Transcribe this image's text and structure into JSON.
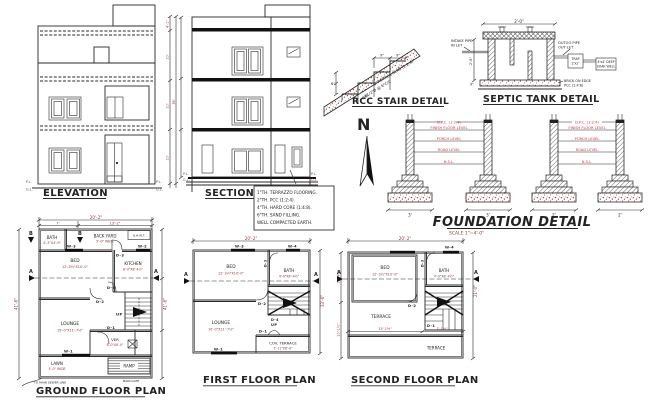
{
  "elevation": {
    "title": "ELEVATION",
    "pl": "P.L.",
    "gl": "G.L.",
    "dim_total": "38'",
    "dim_seg_top": "4'-1\"",
    "dim_seg_1": "10'",
    "dim_seg_2": "10'",
    "dim_seg_3": "10'"
  },
  "section": {
    "title": "SECTION A-A",
    "pl": "P.L.",
    "gl": "G.L."
  },
  "stair": {
    "title": "RCC STAIR DETAIL",
    "slab_note": "6\"THK RCC SLAB (1:2:4)",
    "bar_note": "#1/2\"Ø @ 6\"C/C",
    "bb": "B/B",
    "tread_dim_a": "9\"",
    "tread_dim_b": "9\"",
    "riser_dim": "6\""
  },
  "north": {
    "label": "N"
  },
  "septic": {
    "title": "SEPTIC TANK DETAIL",
    "top_dim": "2'-0\"",
    "inlet_1": "INTAKE PIPE",
    "inlet_2": "IN LET",
    "outlet_1": "OUTGO PIPE",
    "outlet_2": "OUT LET",
    "trap_1": "TRAP",
    "trap_2": "2'x2'",
    "soak_1": "4'x4' DEEP",
    "soak_2": "SOAK WELL",
    "brick": "BRICK ON EDGE",
    "pcc": "PCC (1:4:8)",
    "depth_dim": "2'-6\"",
    "base_dim": "9\""
  },
  "foundation": {
    "title": "FOUNDATION DETAIL",
    "scale": "SCALE 1\"=4'-0\"",
    "labels": [
      "D.P.C. (1:2:4)",
      "FINISH FLOOR LEVEL",
      "PORCH LEVEL",
      "ROAD LEVEL",
      "N.S.L."
    ],
    "dims": [
      "3'",
      "3'",
      "2'",
      "2'"
    ]
  },
  "notes": {
    "lines": [
      "1\"TH. TERRAZZO FLOORING.",
      "2\"TH. PCC (1:2:4).",
      "4\"TH. HARD CORE (1:4:8).",
      "6\"TH. SAND FILLING.",
      "WELL COMPACTED EARTH."
    ]
  },
  "ground": {
    "title": "GROUND FLOOR PLAN",
    "dim_top": "20'-2\"",
    "dim_seg_l": "7'",
    "dim_seg_r": "13'-2\"",
    "dim_side_l": "41'-6\"",
    "dim_side_r": "41'-6\"",
    "bath": "BATH",
    "bath_dim": "4'-3\"X4'-9\"",
    "backyard_1": "BACK YARD",
    "backyard_2": "5'-0\" WIDE",
    "ohwt": "O.H.W.T.",
    "bed": "BED",
    "bed_dim": "12'-3½\"X10'-0\"",
    "kitchen": "KITCHEN",
    "kitchen_dim": "8'-0\"X8'-4½\"",
    "lounge": "LOUNGE",
    "lounge_dim": "10'-0\"X11'-7½\"",
    "ver": "VER",
    "ver_dim": "8'-0\"X6'-0\"",
    "lawn": "LAWN",
    "lawn_dim": "5'-0\" WIDE",
    "ramp": "RAMP",
    "main_gate": "MAIN GATE",
    "sewer": "TO MAIN SEWER LINE",
    "up": "UP",
    "a": "A",
    "b": "B",
    "d1": "D-1",
    "d2": "D-2",
    "d3": "D-3",
    "w1": "W-1",
    "w2": "W-2",
    "w3": "W-3"
  },
  "first": {
    "title": "FIRST FLOOR PLAN",
    "dim_top": "20'-2\"",
    "dim_side": "33'-6\"",
    "bed": "BED",
    "bed_dim": "12'-3½\"X10'-0\"",
    "bath": "BATH",
    "bath_dim": "4'-0\"X8'-4½\"",
    "lounge": "LOUNGE",
    "lounge_dim": "10'-0\"X11'-7½\"",
    "terrace_1": "COV. TERRACE",
    "terrace_2": "7'-11\"X6'-9\"",
    "up": "UP",
    "a": "A",
    "d1": "D-1",
    "d2": "D-2",
    "d3": "D-3",
    "d4": "D-4",
    "w1": "W-1",
    "w3": "W-3",
    "w4": "W-4"
  },
  "second": {
    "title": "SECOND FLOOR PLAN",
    "dim_top": "20'-2\"",
    "dim_side": "21'-0\"",
    "dim_left_a": "11'-4½\"",
    "dim_left_b": "10'-1½\"",
    "dim_bot_a": "13'-1½\"",
    "dim_bot_b": "7'-1½\"",
    "bed": "BED",
    "bed_dim": "12'-3½\"X10'-0\"",
    "bath": "BATH",
    "bath_dim": "4'-0\"X8'-4½\"",
    "terrace_left": "TERRACE",
    "terrace_bottom": "TERRACE",
    "a": "A",
    "d1": "D-1",
    "d2": "D-2",
    "d3": "D-3",
    "w4": "W-4"
  }
}
